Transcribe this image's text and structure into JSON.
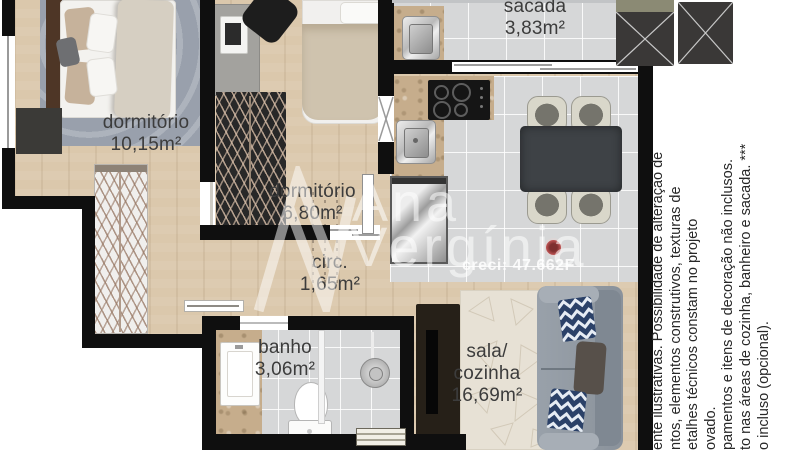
{
  "page": {
    "type": "apartment-floor-plan"
  },
  "floorplan": {
    "rooms": [
      {
        "name": "dormitório",
        "area": "10,15m²"
      },
      {
        "name": "dormitório",
        "area": "6,80m²"
      },
      {
        "name": "circ.",
        "area": "1,65m²"
      },
      {
        "name": "sacada",
        "area": "3,83m²"
      },
      {
        "name": "banho",
        "area": "3,06m²"
      },
      {
        "lines": [
          "sala/",
          "cozinha"
        ],
        "area": "16,69m²"
      }
    ]
  },
  "watermark": {
    "name_line1": "Ana",
    "name_line2": "Vergínia",
    "creci": "creci: 47.662F"
  },
  "disclaimer": {
    "lines": [
      "ente ilustrativas. Possibilidade de alteração de",
      "ntos, elementos construtivos, texturas de",
      "etalhes técnicos constam no projeto",
      "ovado.",
      "pamentos e itens de decoração não inclusos.",
      "to nas áreas de cozinha, banheiro e sacada. ***",
      "o incluso (opcional)."
    ]
  },
  "colors": {
    "wall": "#0f0f0f",
    "wood_floor": "#dbc8ac",
    "tile_floor": "#d6d7d8",
    "granite": "#c6ad8c",
    "label_text": "#3c3c3c",
    "watermark_text": "#ffffff",
    "sofa": "#8e969f",
    "pillow_navy": "#2b4168",
    "disclaimer_text": "#272727"
  }
}
